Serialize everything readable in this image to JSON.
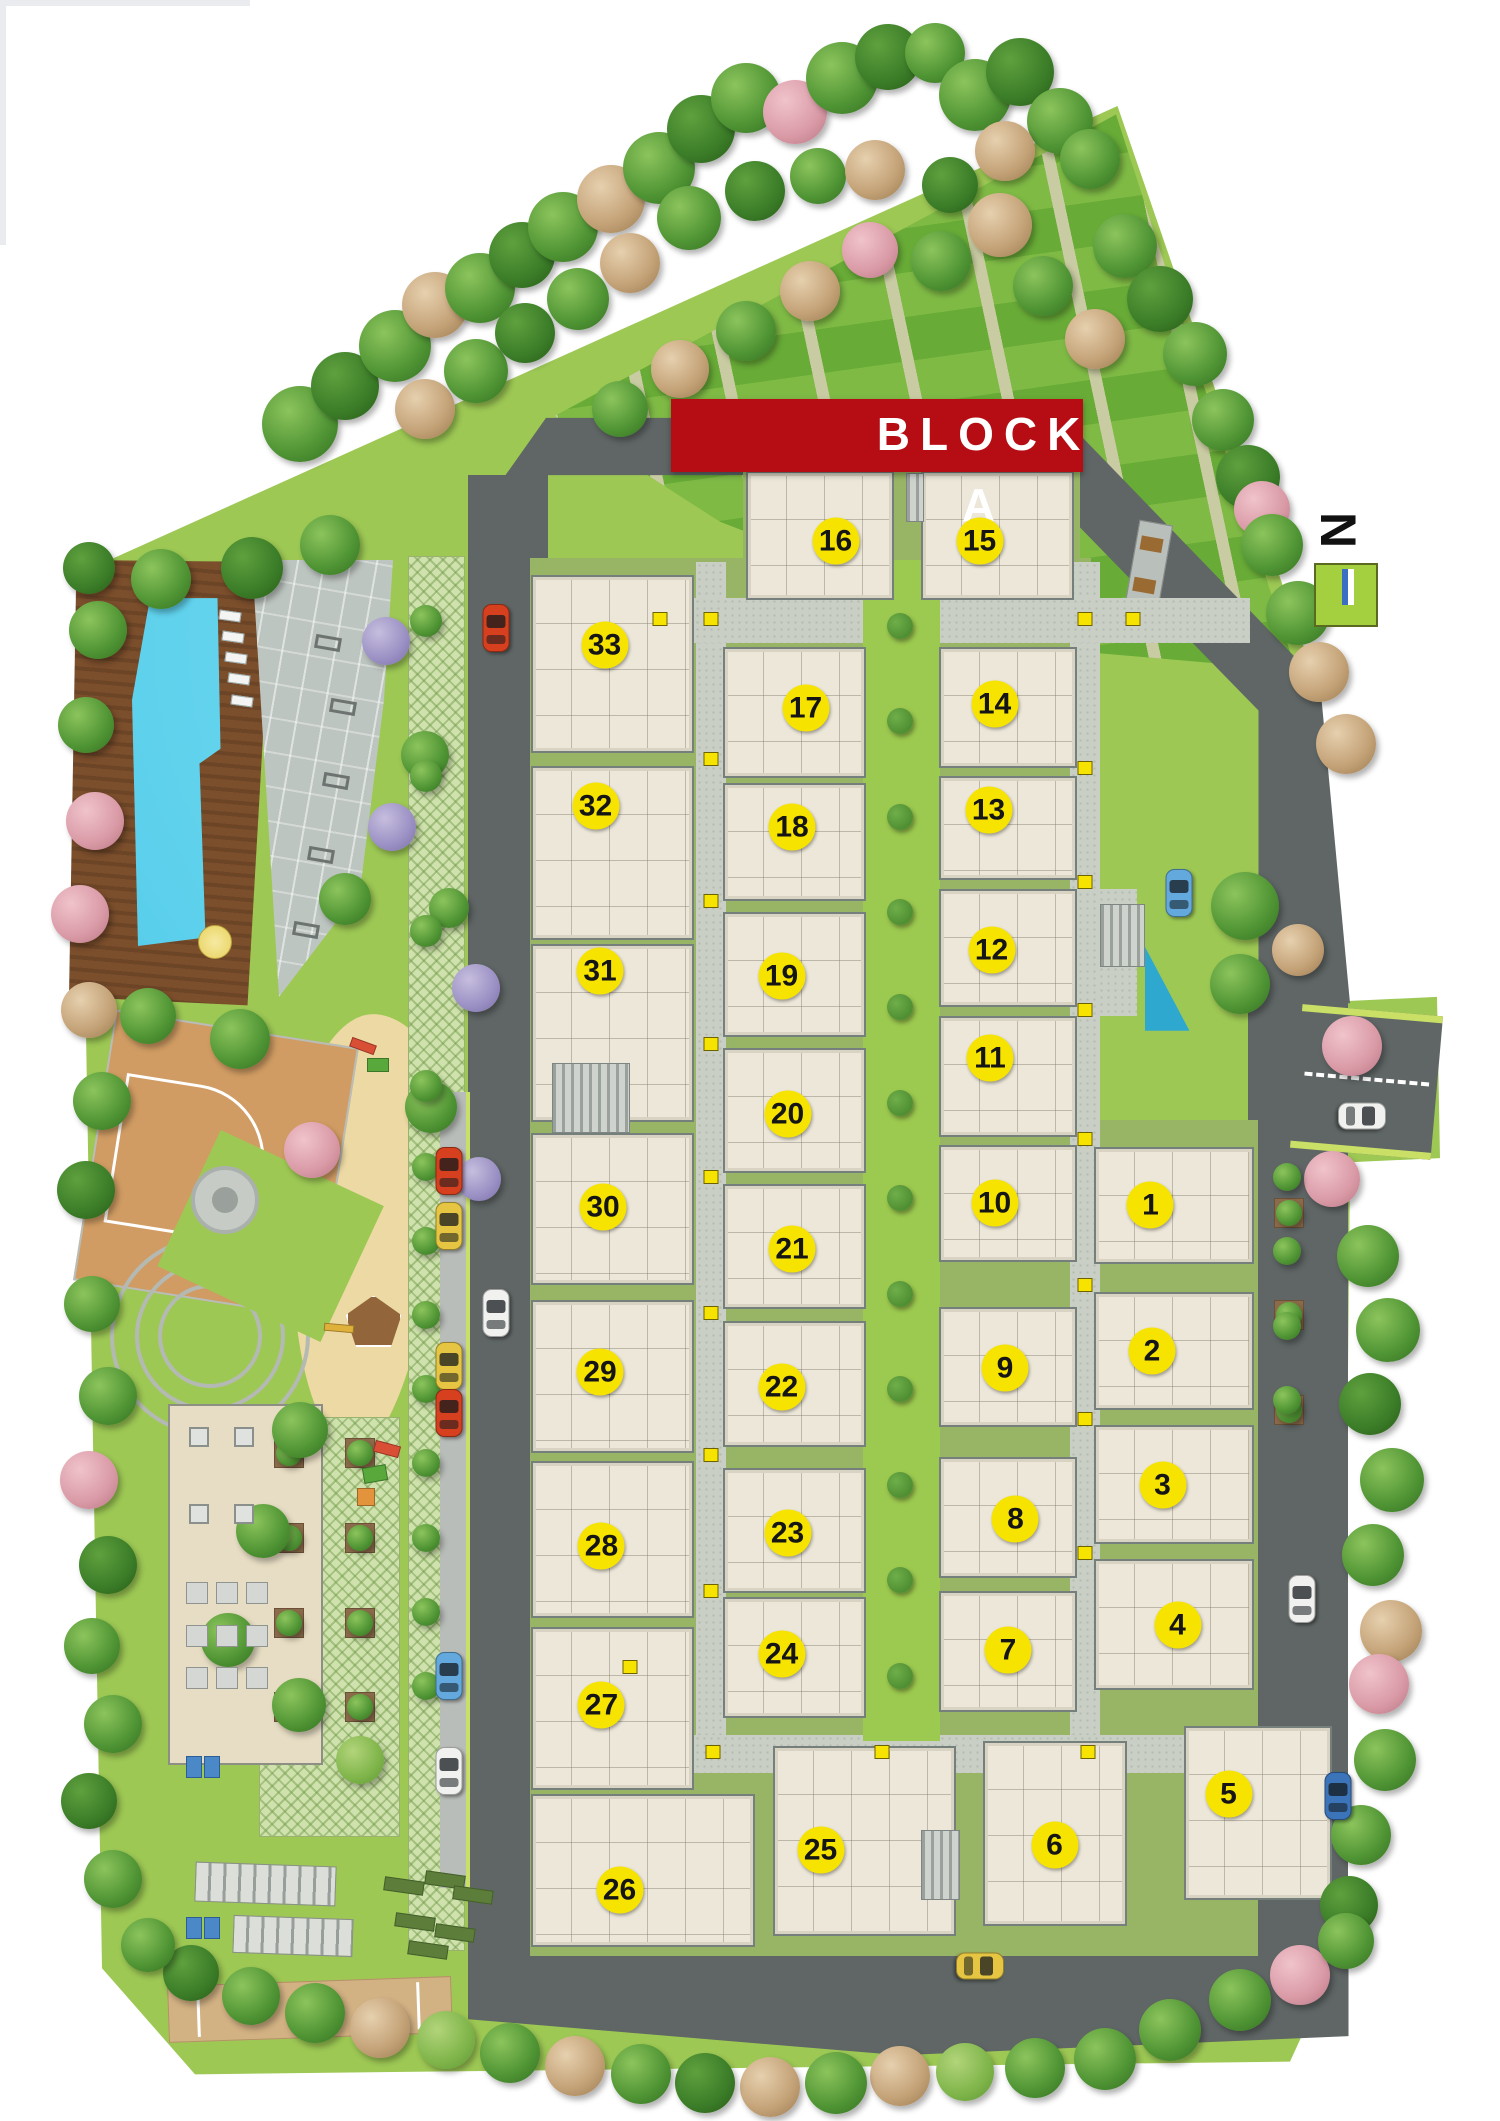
{
  "banner": {
    "label": "BLOCK A"
  },
  "north": {
    "label": "N"
  },
  "colors": {
    "lawn": "#9dc854",
    "verge": "#cadf66",
    "road": "#5f6665",
    "lane": "#b9bdb9",
    "path": "#c9cfc5",
    "pathDot": "#b3bbaf",
    "gap": "#98b465",
    "courtyard": "#9cc94f",
    "unit": "#ece7d9",
    "unitBorder": "#75807d",
    "badge": "#f6e400",
    "banner": "#b50d13",
    "stripeA": "#68ab37",
    "stripeB": "#7fba45",
    "stripeLine": "#c9cba2",
    "pool": "#41c3e6",
    "deck": "#7b4e2c",
    "gym": "#bdc5c0",
    "sand": "#ecd9a4",
    "bcourt": "#d09c63",
    "lattice": "#cfe2ad",
    "bush": "#4f8f33",
    "northGreen": "#a4cf3f"
  },
  "units": [
    {
      "n": "1",
      "x": 76.7,
      "y": 56.8
    },
    {
      "n": "2",
      "x": 76.8,
      "y": 63.7
    },
    {
      "n": "3",
      "x": 77.5,
      "y": 70.0
    },
    {
      "n": "4",
      "x": 78.5,
      "y": 76.6
    },
    {
      "n": "5",
      "x": 81.9,
      "y": 84.6
    },
    {
      "n": "6",
      "x": 70.3,
      "y": 87.0
    },
    {
      "n": "7",
      "x": 67.2,
      "y": 77.8
    },
    {
      "n": "8",
      "x": 67.7,
      "y": 71.6
    },
    {
      "n": "9",
      "x": 67.0,
      "y": 64.5
    },
    {
      "n": "10",
      "x": 66.3,
      "y": 56.7
    },
    {
      "n": "11",
      "x": 66.0,
      "y": 49.9
    },
    {
      "n": "12",
      "x": 66.1,
      "y": 44.8
    },
    {
      "n": "13",
      "x": 65.9,
      "y": 38.2
    },
    {
      "n": "14",
      "x": 66.3,
      "y": 33.2
    },
    {
      "n": "15",
      "x": 65.3,
      "y": 25.5
    },
    {
      "n": "16",
      "x": 55.7,
      "y": 25.5
    },
    {
      "n": "17",
      "x": 53.7,
      "y": 33.4
    },
    {
      "n": "18",
      "x": 52.8,
      "y": 39.0
    },
    {
      "n": "19",
      "x": 52.1,
      "y": 46.0
    },
    {
      "n": "20",
      "x": 52.5,
      "y": 52.5
    },
    {
      "n": "21",
      "x": 52.8,
      "y": 58.9
    },
    {
      "n": "22",
      "x": 52.1,
      "y": 65.4
    },
    {
      "n": "23",
      "x": 52.5,
      "y": 72.3
    },
    {
      "n": "24",
      "x": 52.1,
      "y": 78.0
    },
    {
      "n": "25",
      "x": 54.7,
      "y": 87.2
    },
    {
      "n": "26",
      "x": 41.3,
      "y": 89.1
    },
    {
      "n": "27",
      "x": 40.1,
      "y": 80.4
    },
    {
      "n": "28",
      "x": 40.1,
      "y": 72.9
    },
    {
      "n": "29",
      "x": 40.0,
      "y": 64.7
    },
    {
      "n": "30",
      "x": 40.2,
      "y": 56.9
    },
    {
      "n": "31",
      "x": 40.0,
      "y": 45.8
    },
    {
      "n": "32",
      "x": 39.7,
      "y": 38.0
    },
    {
      "n": "33",
      "x": 40.3,
      "y": 30.4
    }
  ],
  "map": {
    "blocks": [
      [
        49.7,
        22.2,
        9.9,
        6.1
      ],
      [
        61.4,
        22.2,
        10.2,
        6.1
      ],
      [
        35.4,
        27.1,
        10.9,
        8.4
      ],
      [
        35.4,
        36.1,
        10.9,
        8.2
      ],
      [
        35.4,
        44.5,
        10.9,
        8.4
      ],
      [
        35.4,
        53.4,
        10.9,
        7.2
      ],
      [
        35.4,
        61.3,
        10.9,
        7.2
      ],
      [
        35.4,
        68.9,
        10.9,
        7.4
      ],
      [
        35.4,
        76.7,
        10.9,
        7.7
      ],
      [
        35.4,
        84.6,
        14.9,
        7.2
      ],
      [
        48.2,
        30.5,
        9.5,
        6.2
      ],
      [
        48.2,
        36.9,
        9.5,
        5.6
      ],
      [
        48.2,
        43.0,
        9.5,
        5.9
      ],
      [
        48.2,
        49.4,
        9.5,
        5.9
      ],
      [
        48.2,
        55.8,
        9.5,
        5.9
      ],
      [
        48.2,
        62.3,
        9.5,
        5.9
      ],
      [
        48.2,
        69.2,
        9.5,
        5.9
      ],
      [
        48.2,
        75.3,
        9.5,
        5.7
      ],
      [
        51.5,
        82.3,
        12.2,
        9.0
      ],
      [
        62.6,
        30.5,
        9.2,
        5.7
      ],
      [
        62.6,
        36.6,
        9.2,
        4.9
      ],
      [
        62.6,
        41.9,
        9.2,
        5.6
      ],
      [
        62.6,
        47.9,
        9.2,
        5.7
      ],
      [
        62.6,
        54.0,
        9.2,
        5.5
      ],
      [
        62.6,
        61.6,
        9.2,
        5.7
      ],
      [
        62.6,
        68.7,
        9.2,
        5.7
      ],
      [
        62.6,
        75.0,
        9.2,
        5.7
      ],
      [
        65.5,
        82.1,
        9.6,
        8.7
      ],
      [
        72.9,
        54.1,
        10.7,
        5.5
      ],
      [
        72.9,
        60.9,
        10.7,
        5.6
      ],
      [
        72.9,
        67.2,
        10.7,
        5.6
      ],
      [
        72.9,
        73.5,
        10.7,
        6.2
      ],
      [
        78.9,
        81.4,
        9.9,
        8.2
      ]
    ],
    "stairs": [
      [
        36.8,
        50.1,
        5.2,
        3.3
      ],
      [
        73.3,
        42.6,
        3.0,
        3.0
      ],
      [
        61.4,
        86.3,
        2.6,
        3.3
      ],
      [
        60.4,
        22.3,
        1.2,
        2.3
      ]
    ],
    "bushes": [
      [
        60,
        29.5
      ],
      [
        60,
        34
      ],
      [
        60,
        38.5
      ],
      [
        60,
        43
      ],
      [
        60,
        47.5
      ],
      [
        60,
        52
      ],
      [
        60,
        56.5
      ],
      [
        60,
        61
      ],
      [
        60,
        65.5
      ],
      [
        60,
        70
      ],
      [
        60,
        74.5
      ],
      [
        60,
        79
      ]
    ],
    "markers": [
      [
        47.4,
        29.2
      ],
      [
        47.4,
        35.8
      ],
      [
        47.4,
        42.5
      ],
      [
        47.4,
        49.2
      ],
      [
        47.4,
        55.5
      ],
      [
        47.4,
        61.9
      ],
      [
        47.4,
        68.6
      ],
      [
        47.4,
        75.0
      ],
      [
        72.3,
        29.2
      ],
      [
        72.3,
        36.2
      ],
      [
        72.3,
        41.6
      ],
      [
        72.3,
        47.6
      ],
      [
        72.3,
        53.7
      ],
      [
        72.3,
        60.6
      ],
      [
        72.3,
        66.9
      ],
      [
        72.3,
        73.2
      ],
      [
        44.0,
        29.2
      ],
      [
        75.5,
        29.2
      ],
      [
        58.8,
        82.6
      ],
      [
        72.5,
        82.6
      ],
      [
        47.5,
        82.6
      ],
      [
        42.0,
        78.6
      ]
    ],
    "trees": [
      [
        20,
        20,
        38,
        "G"
      ],
      [
        23,
        18.2,
        34,
        "d"
      ],
      [
        26.3,
        16.3,
        36,
        "G"
      ],
      [
        29,
        14.4,
        33,
        "t"
      ],
      [
        32,
        13.6,
        35,
        "G"
      ],
      [
        34.8,
        12,
        33,
        "d"
      ],
      [
        37.5,
        10.7,
        35,
        "G"
      ],
      [
        40.7,
        9.4,
        34,
        "t"
      ],
      [
        43.9,
        7.9,
        36,
        "G"
      ],
      [
        46.7,
        6.1,
        34,
        "d"
      ],
      [
        49.7,
        4.6,
        35,
        "G"
      ],
      [
        53,
        5.3,
        32,
        "p"
      ],
      [
        56.1,
        3.7,
        36,
        "G"
      ],
      [
        59.2,
        2.7,
        33,
        "d"
      ],
      [
        62.3,
        2.5,
        30,
        "G"
      ],
      [
        28.3,
        19.3,
        30,
        "t"
      ],
      [
        31.7,
        17.5,
        32,
        "G"
      ],
      [
        35,
        15.7,
        30,
        "d"
      ],
      [
        38.5,
        14.1,
        31,
        "G"
      ],
      [
        42,
        12.4,
        30,
        "t"
      ],
      [
        45.9,
        10.3,
        32,
        "G"
      ],
      [
        50.3,
        9,
        30,
        "d"
      ],
      [
        54.5,
        8.3,
        28,
        "G"
      ],
      [
        58.3,
        8,
        30,
        "t"
      ],
      [
        65,
        4.5,
        36,
        "G"
      ],
      [
        68,
        3.4,
        34,
        "d"
      ],
      [
        70.7,
        5.7,
        33,
        "G"
      ],
      [
        67,
        7.1,
        30,
        "t"
      ],
      [
        72.7,
        7.5,
        30,
        "G"
      ],
      [
        63.3,
        8.7,
        28,
        "d"
      ],
      [
        66.7,
        10.6,
        32,
        "t"
      ],
      [
        62.7,
        12.3,
        30,
        "G"
      ],
      [
        58,
        11.8,
        28,
        "p"
      ],
      [
        54,
        13.7,
        30,
        "t"
      ],
      [
        49.7,
        15.6,
        30,
        "G"
      ],
      [
        45.3,
        17.4,
        29,
        "t"
      ],
      [
        41.3,
        19.3,
        28,
        "G"
      ],
      [
        69.5,
        13.5,
        30,
        "G"
      ],
      [
        73,
        16,
        30,
        "t"
      ],
      [
        75,
        11.6,
        32,
        "G"
      ],
      [
        77.3,
        14.1,
        33,
        "d"
      ],
      [
        79.7,
        16.7,
        32,
        "G"
      ],
      [
        81.5,
        19.8,
        31,
        "G"
      ],
      [
        83.2,
        22.5,
        32,
        "d"
      ],
      [
        84.1,
        24,
        28,
        "p"
      ],
      [
        84.8,
        25.7,
        31,
        "G"
      ],
      [
        86.5,
        28.9,
        32,
        "G"
      ],
      [
        87.9,
        31.7,
        30,
        "t"
      ],
      [
        89.7,
        35.1,
        30,
        "t"
      ],
      [
        83,
        42.7,
        34,
        "G"
      ],
      [
        86.5,
        44.8,
        26,
        "t"
      ],
      [
        82.7,
        46.4,
        30,
        "G"
      ],
      [
        90.1,
        49.3,
        30,
        "p"
      ],
      [
        88.8,
        55.6,
        28,
        "p"
      ],
      [
        91.2,
        59.2,
        31,
        "G"
      ],
      [
        92.5,
        62.7,
        32,
        "G"
      ],
      [
        91.3,
        66.2,
        31,
        "d"
      ],
      [
        92.8,
        69.8,
        32,
        "G"
      ],
      [
        91.5,
        73.3,
        31,
        "G"
      ],
      [
        92.7,
        76.9,
        31,
        "t"
      ],
      [
        91.9,
        79.4,
        30,
        "p"
      ],
      [
        92.3,
        83,
        31,
        "G"
      ],
      [
        90.7,
        86.5,
        30,
        "G"
      ],
      [
        89.9,
        89.8,
        29,
        "d"
      ],
      [
        86.7,
        93.1,
        30,
        "p"
      ],
      [
        89.7,
        91.5,
        28,
        "G"
      ],
      [
        82.7,
        94.3,
        31,
        "G"
      ],
      [
        78,
        95.7,
        31,
        "G"
      ],
      [
        73.7,
        97.1,
        31,
        "G"
      ],
      [
        69,
        97.5,
        30,
        "G"
      ],
      [
        64.3,
        97.7,
        29,
        "g"
      ],
      [
        60,
        97.9,
        30,
        "t"
      ],
      [
        55.7,
        98.2,
        31,
        "G"
      ],
      [
        51.3,
        98.4,
        30,
        "t"
      ],
      [
        47,
        98.2,
        30,
        "d"
      ],
      [
        42.7,
        97.8,
        30,
        "G"
      ],
      [
        38.3,
        97.4,
        30,
        "t"
      ],
      [
        34,
        96.8,
        30,
        "G"
      ],
      [
        29.7,
        96.2,
        29,
        "g"
      ],
      [
        25.3,
        95.6,
        30,
        "t"
      ],
      [
        21,
        94.9,
        30,
        "G"
      ],
      [
        16.7,
        94.1,
        29,
        "G"
      ],
      [
        12.7,
        93,
        28,
        "d"
      ],
      [
        9.9,
        91.7,
        27,
        "G"
      ],
      [
        7.5,
        88.6,
        29,
        "G"
      ],
      [
        5.9,
        84.9,
        28,
        "d"
      ],
      [
        7.5,
        81.3,
        29,
        "G"
      ],
      [
        6.1,
        77.6,
        28,
        "G"
      ],
      [
        7.2,
        73.8,
        29,
        "d"
      ],
      [
        5.9,
        69.8,
        29,
        "p"
      ],
      [
        7.2,
        65.8,
        29,
        "G"
      ],
      [
        6.1,
        61.5,
        28,
        "G"
      ],
      [
        5.7,
        56.1,
        29,
        "d"
      ],
      [
        6.8,
        51.9,
        29,
        "G"
      ],
      [
        5.9,
        47.6,
        28,
        "t"
      ],
      [
        5.3,
        43.1,
        29,
        "p"
      ],
      [
        6.3,
        38.7,
        29,
        "p"
      ],
      [
        5.7,
        34.2,
        28,
        "G"
      ],
      [
        6.5,
        29.7,
        29,
        "G"
      ],
      [
        5.9,
        26.8,
        26,
        "d"
      ],
      [
        10.7,
        27.3,
        30,
        "G"
      ],
      [
        16.8,
        26.8,
        31,
        "d"
      ],
      [
        22,
        25.7,
        30,
        "G"
      ],
      [
        9.9,
        47.9,
        28,
        "G"
      ],
      [
        16,
        49,
        30,
        "G"
      ],
      [
        20.8,
        54.2,
        28,
        "p"
      ],
      [
        25.7,
        30.2,
        24,
        "v"
      ],
      [
        26.1,
        39,
        24,
        "v"
      ],
      [
        23,
        42.4,
        26,
        "G"
      ],
      [
        29.9,
        42.8,
        20,
        "G"
      ],
      [
        31.7,
        46.6,
        24,
        "v"
      ],
      [
        28.7,
        52.2,
        26,
        "G"
      ],
      [
        31.9,
        55.6,
        22,
        "v"
      ],
      [
        20,
        67.4,
        28,
        "G"
      ],
      [
        17.5,
        72.2,
        27,
        "G"
      ],
      [
        15.2,
        77.3,
        27,
        "G"
      ],
      [
        19.9,
        80.4,
        27,
        "G"
      ],
      [
        24,
        83,
        24,
        "g"
      ],
      [
        28.3,
        35.6,
        24,
        "G"
      ],
      [
        28.4,
        29.3,
        16,
        "G"
      ],
      [
        28.4,
        36.6,
        16,
        "G"
      ],
      [
        28.4,
        43.9,
        16,
        "G"
      ],
      [
        28.4,
        51.2,
        16,
        "G"
      ],
      [
        28.4,
        55,
        14,
        "G"
      ],
      [
        28.4,
        58.5,
        14,
        "G"
      ],
      [
        28.4,
        62,
        14,
        "G"
      ],
      [
        28.4,
        65.5,
        14,
        "G"
      ],
      [
        28.4,
        69,
        14,
        "G"
      ],
      [
        28.4,
        72.5,
        14,
        "G"
      ],
      [
        28.4,
        76,
        14,
        "G"
      ],
      [
        28.4,
        79.5,
        14,
        "G"
      ],
      [
        85.8,
        55.5,
        14,
        "G"
      ],
      [
        85.8,
        59,
        14,
        "G"
      ],
      [
        85.8,
        62.5,
        14,
        "G"
      ],
      [
        85.8,
        66,
        14,
        "G"
      ]
    ],
    "cars": [
      [
        33.1,
        29.6,
        "red",
        0
      ],
      [
        33.1,
        61.9,
        "white",
        0
      ],
      [
        29.9,
        55.2,
        "red",
        0
      ],
      [
        29.9,
        57.8,
        "yellow",
        0
      ],
      [
        29.9,
        64.4,
        "yellow",
        0
      ],
      [
        29.9,
        66.6,
        "red",
        0
      ],
      [
        29.9,
        79.0,
        "blue",
        0
      ],
      [
        29.9,
        83.5,
        "white",
        0
      ],
      [
        78.6,
        42.1,
        "blue",
        0
      ],
      [
        86.8,
        75.4,
        "white",
        0
      ],
      [
        89.2,
        84.7,
        "navy",
        0
      ],
      [
        65.3,
        92.7,
        "yellow",
        90
      ],
      [
        90.8,
        52.6,
        "white",
        90
      ]
    ],
    "planters": [
      [
        19.3,
        68.5
      ],
      [
        24,
        68.5
      ],
      [
        19.3,
        72.5
      ],
      [
        24,
        72.5
      ],
      [
        19.3,
        76.5
      ],
      [
        24,
        76.5
      ],
      [
        19.3,
        80.5
      ],
      [
        24,
        80.5
      ],
      [
        85.9,
        57.2
      ],
      [
        85.9,
        62
      ],
      [
        85.9,
        66.5
      ]
    ],
    "greenslots": [
      [
        25.6,
        88.6
      ],
      [
        28.3,
        88.3
      ],
      [
        30.2,
        89.0
      ],
      [
        26.3,
        90.3
      ],
      [
        29.0,
        90.8
      ],
      [
        27.2,
        91.6
      ]
    ],
    "equip": [
      [
        21,
        30
      ],
      [
        22,
        33
      ],
      [
        21.5,
        36.5
      ],
      [
        20.5,
        40
      ],
      [
        19.5,
        43.5
      ]
    ],
    "playitems": [
      [
        24.2,
        49.3,
        "#d94f35",
        26,
        10,
        20
      ],
      [
        25.2,
        50.2,
        "#58a83c",
        22,
        14,
        0
      ],
      [
        25.8,
        68.3,
        "#d94f35",
        26,
        12,
        15
      ],
      [
        25.0,
        69.5,
        "#58a83c",
        24,
        16,
        -10
      ],
      [
        24.4,
        70.6,
        "#e2933b",
        18,
        18,
        0
      ],
      [
        22.6,
        62.6,
        "#e0b13a",
        30,
        8,
        5
      ]
    ],
    "loungers": [
      [
        14.6,
        28.8
      ],
      [
        14.8,
        29.8
      ],
      [
        15.0,
        30.8
      ],
      [
        15.2,
        31.8
      ],
      [
        15.4,
        32.8
      ]
    ],
    "tables": [
      [
        12.6,
        70.9
      ],
      [
        15.6,
        70.9
      ],
      [
        12.6,
        67.3
      ],
      [
        15.6,
        67.3
      ]
    ],
    "grid9": [
      [
        12.4,
        74.6
      ],
      [
        14.4,
        74.6
      ],
      [
        16.4,
        74.6
      ],
      [
        12.4,
        76.6
      ],
      [
        14.4,
        76.6
      ],
      [
        16.4,
        76.6
      ],
      [
        12.4,
        78.6
      ],
      [
        14.4,
        78.6
      ],
      [
        16.4,
        78.6
      ]
    ],
    "wcs": [
      [
        12.4,
        82.8
      ],
      [
        13.6,
        82.8
      ],
      [
        12.4,
        90.4
      ],
      [
        13.6,
        90.4
      ]
    ]
  }
}
